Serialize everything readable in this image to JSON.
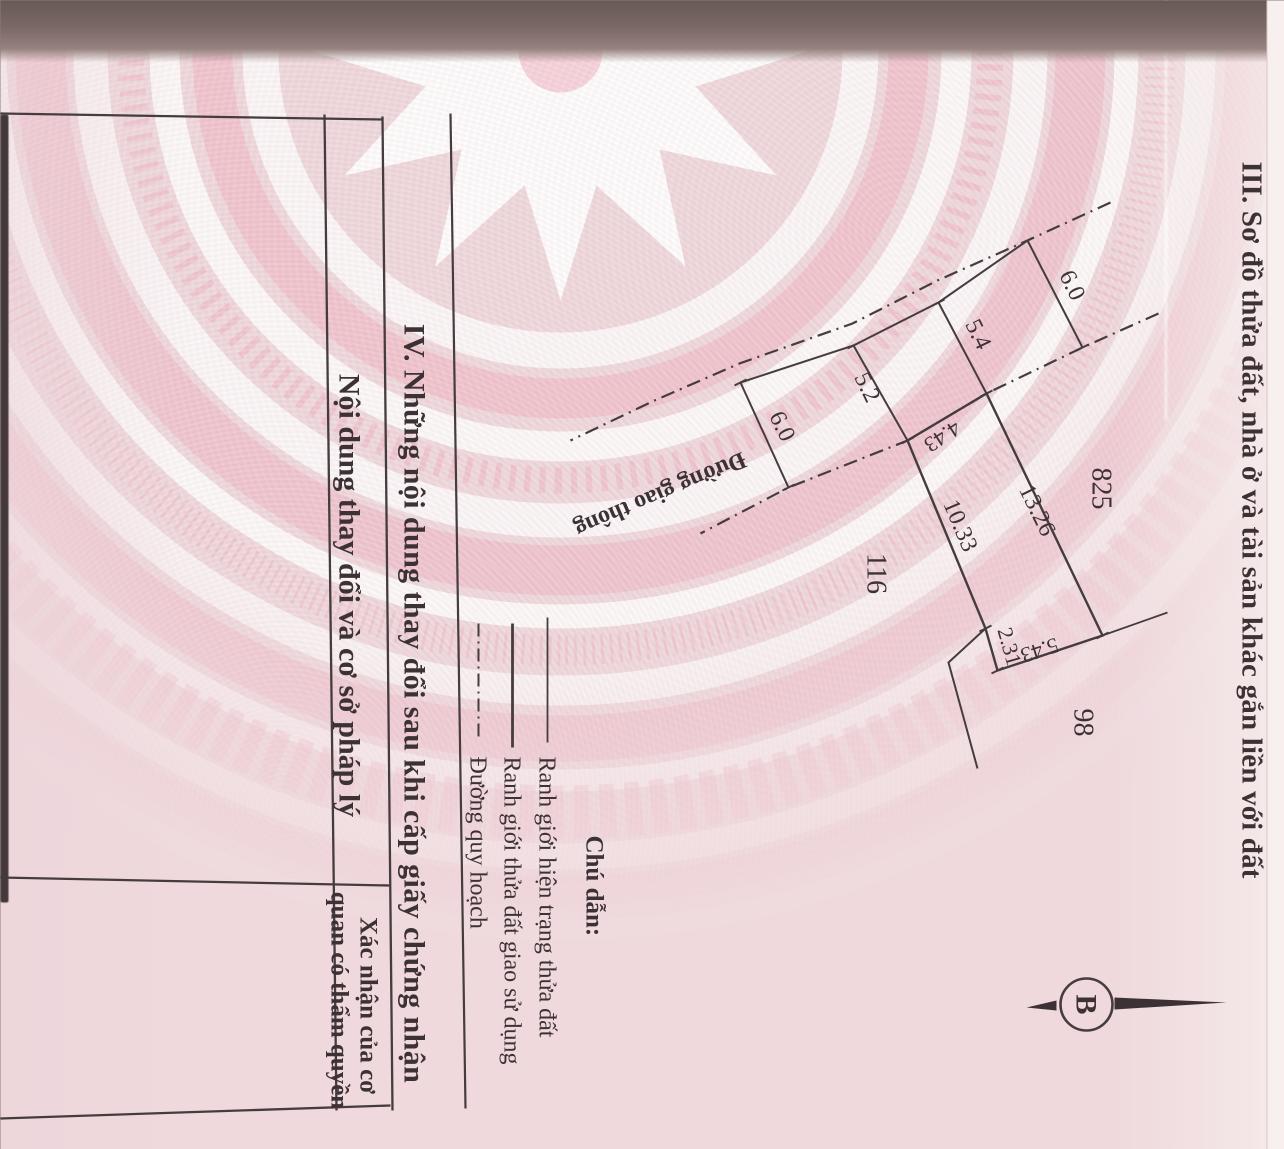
{
  "page": {
    "section3_title": "III. Sơ đồ thửa đất, nhà ở và tài sản khác gắn liền với đất",
    "section4_title": "IV. Những nội dung thay đổi sau khi cấp giấy chứng nhận"
  },
  "diagram": {
    "road_label": "Đường giao thông",
    "dimensions": {
      "tick1": "6.0",
      "tick2": "5.4",
      "tick3": "5.2",
      "tick4": "6.0",
      "front": "4.43",
      "side_left": "13.26",
      "side_right": "10.33",
      "back1": "2.31",
      "back2": "5.43"
    },
    "parcel_numbers": {
      "upper": "825",
      "lower": "116",
      "right": "98"
    },
    "compass_label": "B"
  },
  "legend": {
    "title": "Chú dẫn:",
    "items": [
      {
        "style": "solid-thin",
        "label": "Ranh giới hiện trạng thửa đất"
      },
      {
        "style": "solid",
        "label": "Ranh giới thửa đất giao sử dụng"
      },
      {
        "style": "dash-dot",
        "label": "Đường quy hoạch"
      }
    ]
  },
  "table": {
    "col1_header": "Nội dung thay đổi và cơ sở pháp lý",
    "col2_header_line1": "Xác nhận của cơ",
    "col2_header_line2": "quan có thẩm quyền"
  },
  "colors": {
    "paper": "#efd9dd",
    "pattern_pink": "#f0b4c1",
    "ink": "#3c3236",
    "fold_shadow": "#7b6a66"
  }
}
